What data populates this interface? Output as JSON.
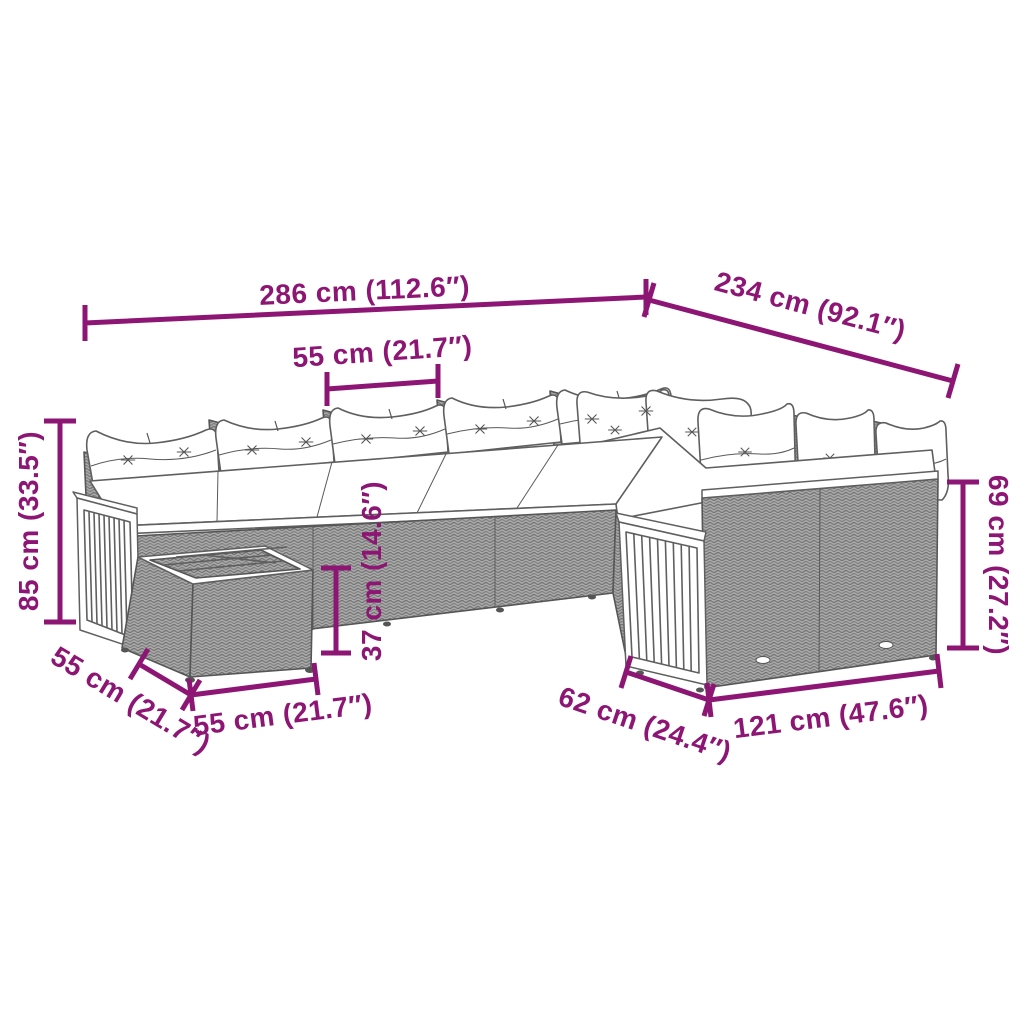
{
  "canvas": {
    "width": 1024,
    "height": 1024,
    "background": "#ffffff"
  },
  "diagram": {
    "kind": "product-dimension-diagram",
    "subject": "L-shaped poly rattan garden sofa set with cushions, acacia wood slat panels and side table",
    "accent_color": "#8D1674",
    "line_art_color": "#5f5f5f"
  },
  "dims": {
    "width_total": {
      "label": "286 cm (112.6″)"
    },
    "depth_total": {
      "label": "234 cm (92.1″)"
    },
    "seat_width": {
      "label": "55 cm (21.7″)"
    },
    "height_left": {
      "label": "85 cm (33.5″)"
    },
    "height_right": {
      "label": "69 cm (27.2″)"
    },
    "table_height": {
      "label": "37 cm (14.6″)"
    },
    "table_depth": {
      "label": "55 cm (21.7″)"
    },
    "table_width": {
      "label": "55 cm (21.7″)"
    },
    "wing_depth": {
      "label": "62 cm (24.4″)"
    },
    "wing_width": {
      "label": "121 cm (47.6″)"
    }
  }
}
